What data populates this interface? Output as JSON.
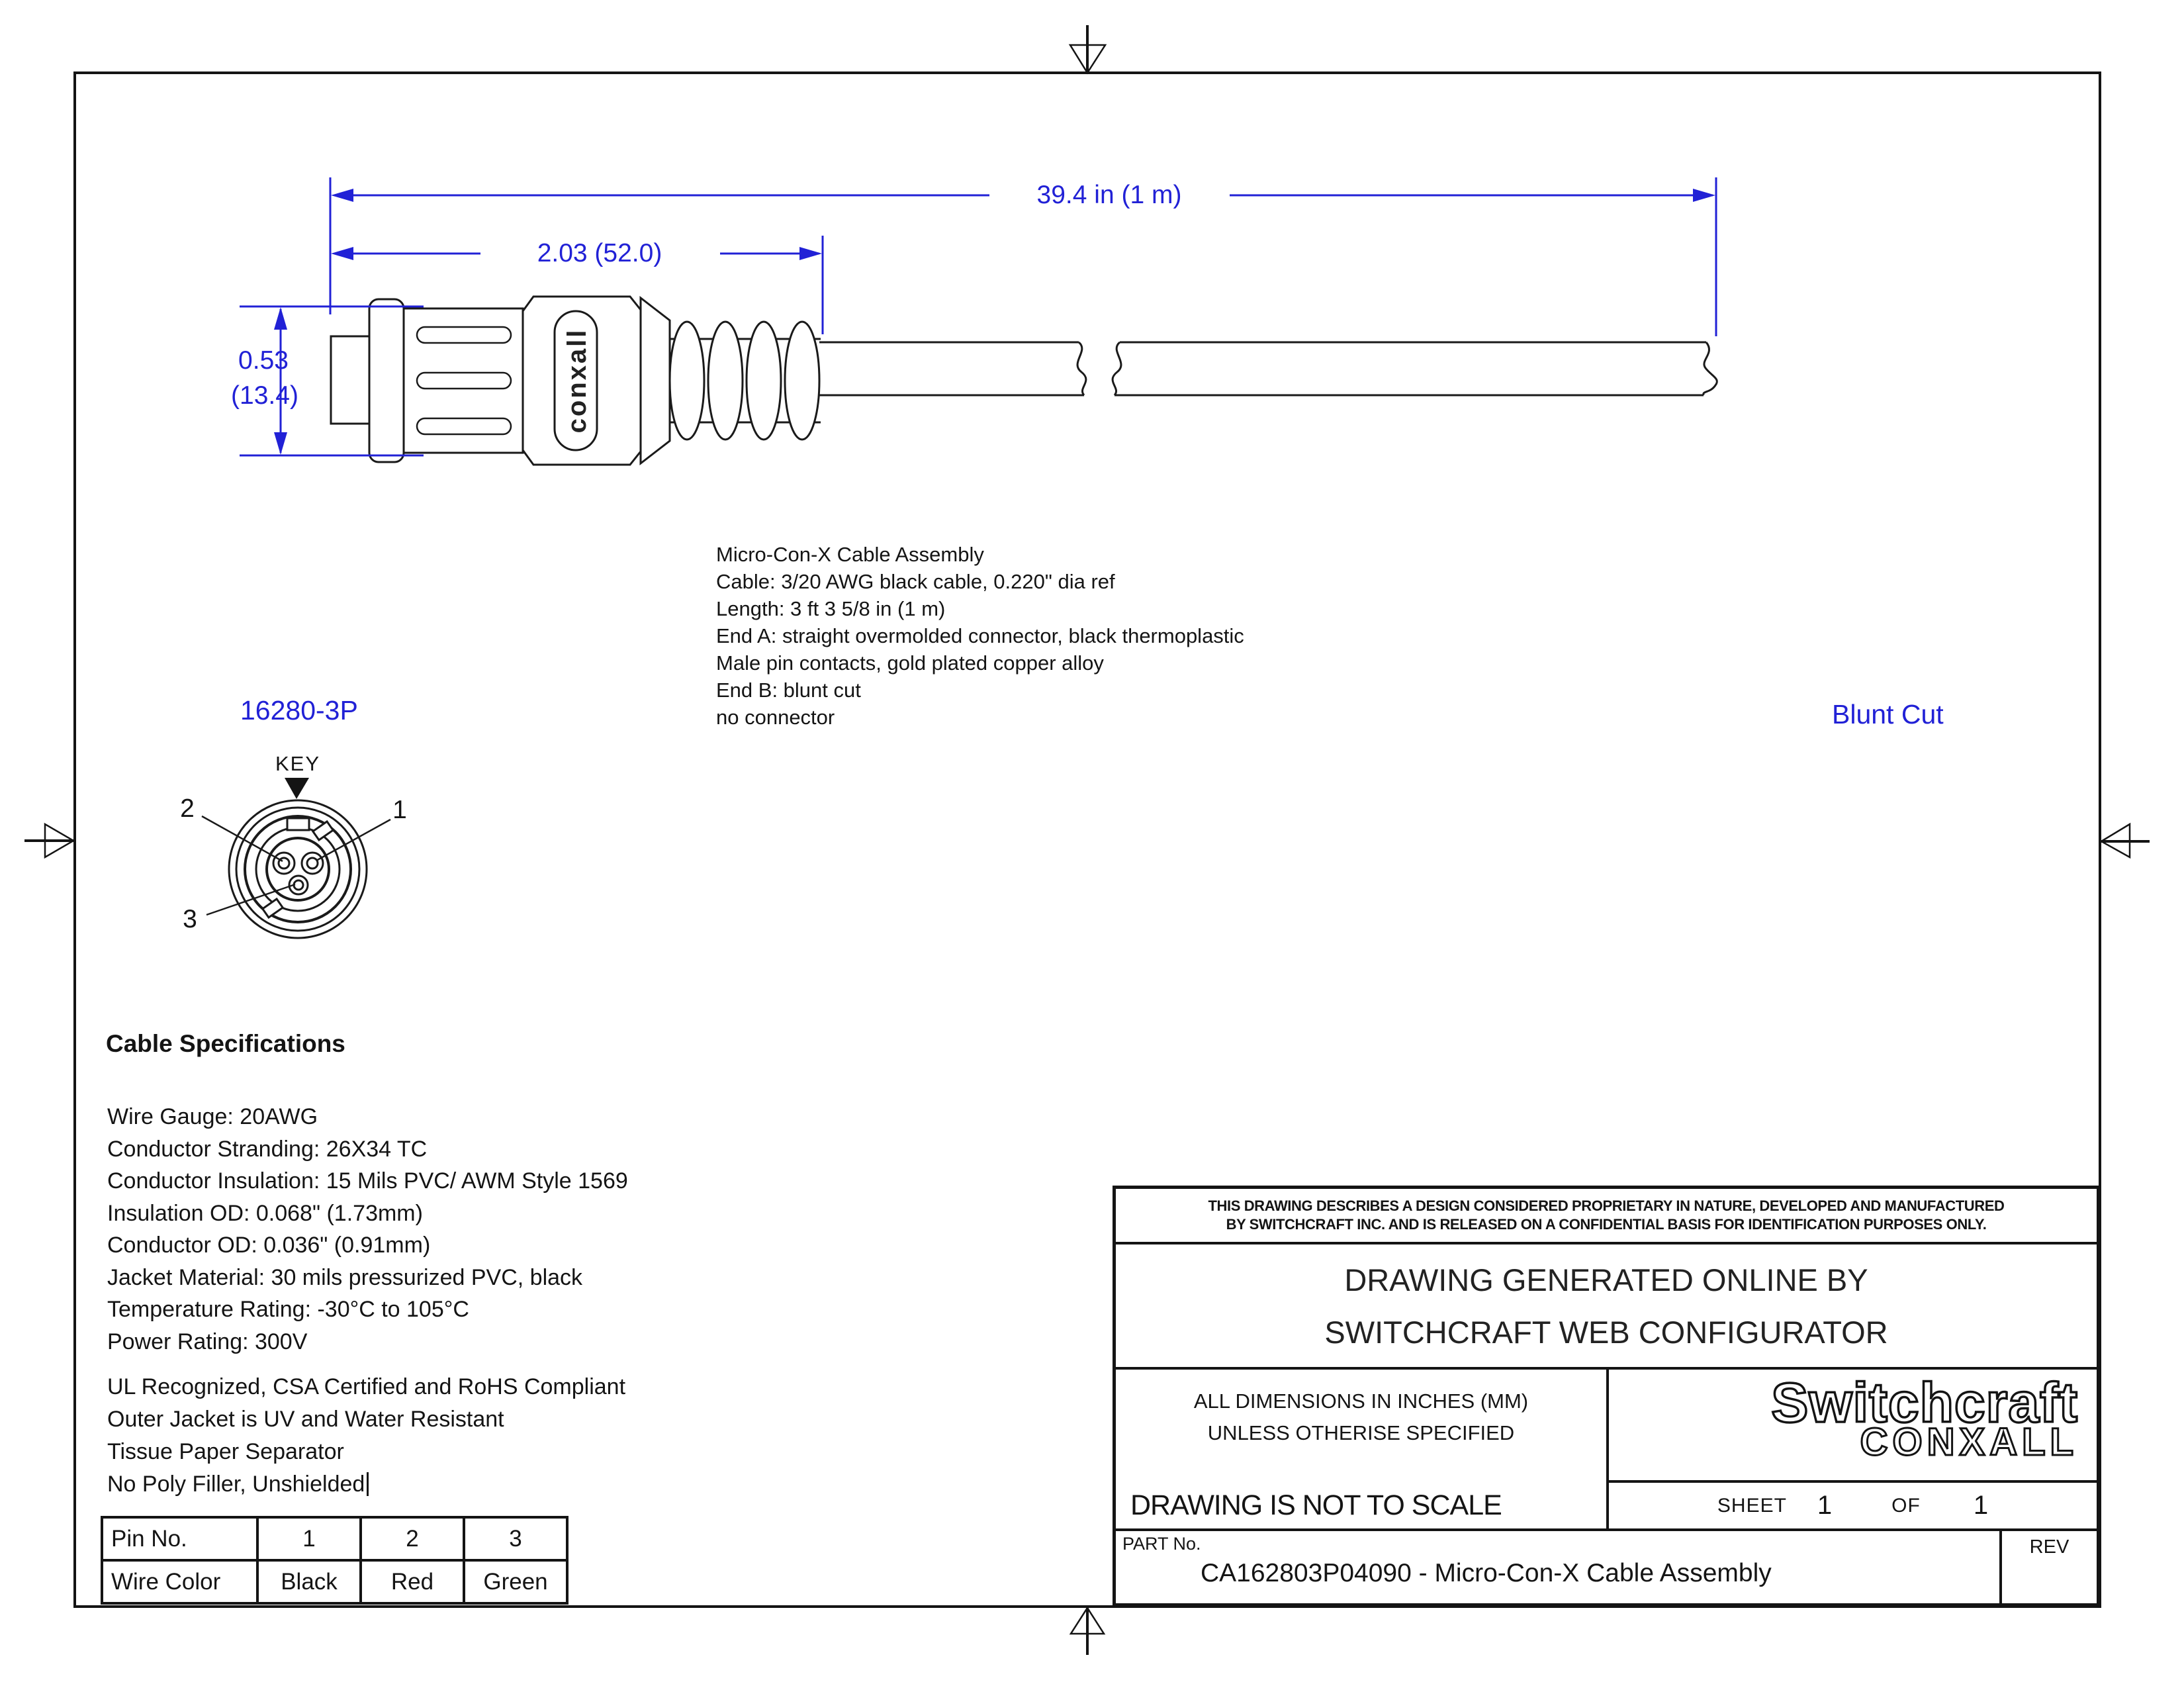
{
  "colors": {
    "accent_blue": "#2121d6",
    "line_black": "#141414"
  },
  "drawing": {
    "dim_overall": "39.4 in (1 m)",
    "dim_connector": "2.03 (52.0)",
    "dim_dia_in": "0.53",
    "dim_dia_mm": "(13.4)",
    "end_a_part": "16280-3P",
    "end_b_label": "Blunt Cut",
    "key_label": "KEY",
    "pin1": "1",
    "pin2": "2",
    "pin3": "3",
    "connector_brand": "conxall"
  },
  "description": {
    "lines": [
      "Micro-Con-X Cable Assembly",
      "Cable: 3/20 AWG black cable, 0.220\" dia ref",
      "Length: 3 ft 3 5/8 in (1 m)",
      "End A: straight overmolded connector, black thermoplastic",
      "Male pin contacts, gold plated copper alloy",
      "End B: blunt cut",
      "no connector"
    ]
  },
  "cable_specs": {
    "title": "Cable Specifications",
    "lines": [
      "Wire Gauge: 20AWG",
      "Conductor Stranding: 26X34 TC",
      "Conductor Insulation: 15 Mils PVC/ AWM Style 1569",
      "Insulation OD: 0.068\" (1.73mm)",
      "Conductor OD: 0.036\" (0.91mm)",
      "Jacket Material: 30 mils pressurized PVC, black",
      "Temperature Rating: -30°C to 105°C",
      "Power Rating: 300V"
    ],
    "compliance": [
      "UL Recognized, CSA Certified and RoHS Compliant",
      "Outer Jacket is UV and Water Resistant",
      "Tissue Paper Separator",
      "No Poly Filler, Unshielded"
    ]
  },
  "pin_table": {
    "headers": [
      "Pin No.",
      "1",
      "2",
      "3"
    ],
    "row_label": "Wire Color",
    "row_values": [
      "Black",
      "Red",
      "Green"
    ]
  },
  "title_block": {
    "proprietary_line1": "THIS DRAWING DESCRIBES A DESIGN CONSIDERED PROPRIETARY IN NATURE, DEVELOPED AND MANUFACTURED",
    "proprietary_line2": "BY SWITCHCRAFT INC. AND IS RELEASED ON A CONFIDENTIAL BASIS FOR IDENTIFICATION PURPOSES ONLY.",
    "generated_line1": "DRAWING GENERATED ONLINE BY",
    "generated_line2": "SWITCHCRAFT WEB CONFIGURATOR",
    "dims_note_line1": "ALL DIMENSIONS IN INCHES (MM)",
    "dims_note_line2": "UNLESS OTHERISE SPECIFIED",
    "scale_note": "DRAWING IS NOT TO SCALE",
    "logo_line1": "Switchcraft",
    "logo_line2": "CONXALL",
    "sheet_label": "SHEET",
    "sheet_num": "1",
    "of_label": "OF",
    "of_num": "1",
    "part_label": "PART No.",
    "part_value": "CA162803P04090 - Micro-Con-X Cable Assembly",
    "rev_label": "REV"
  }
}
